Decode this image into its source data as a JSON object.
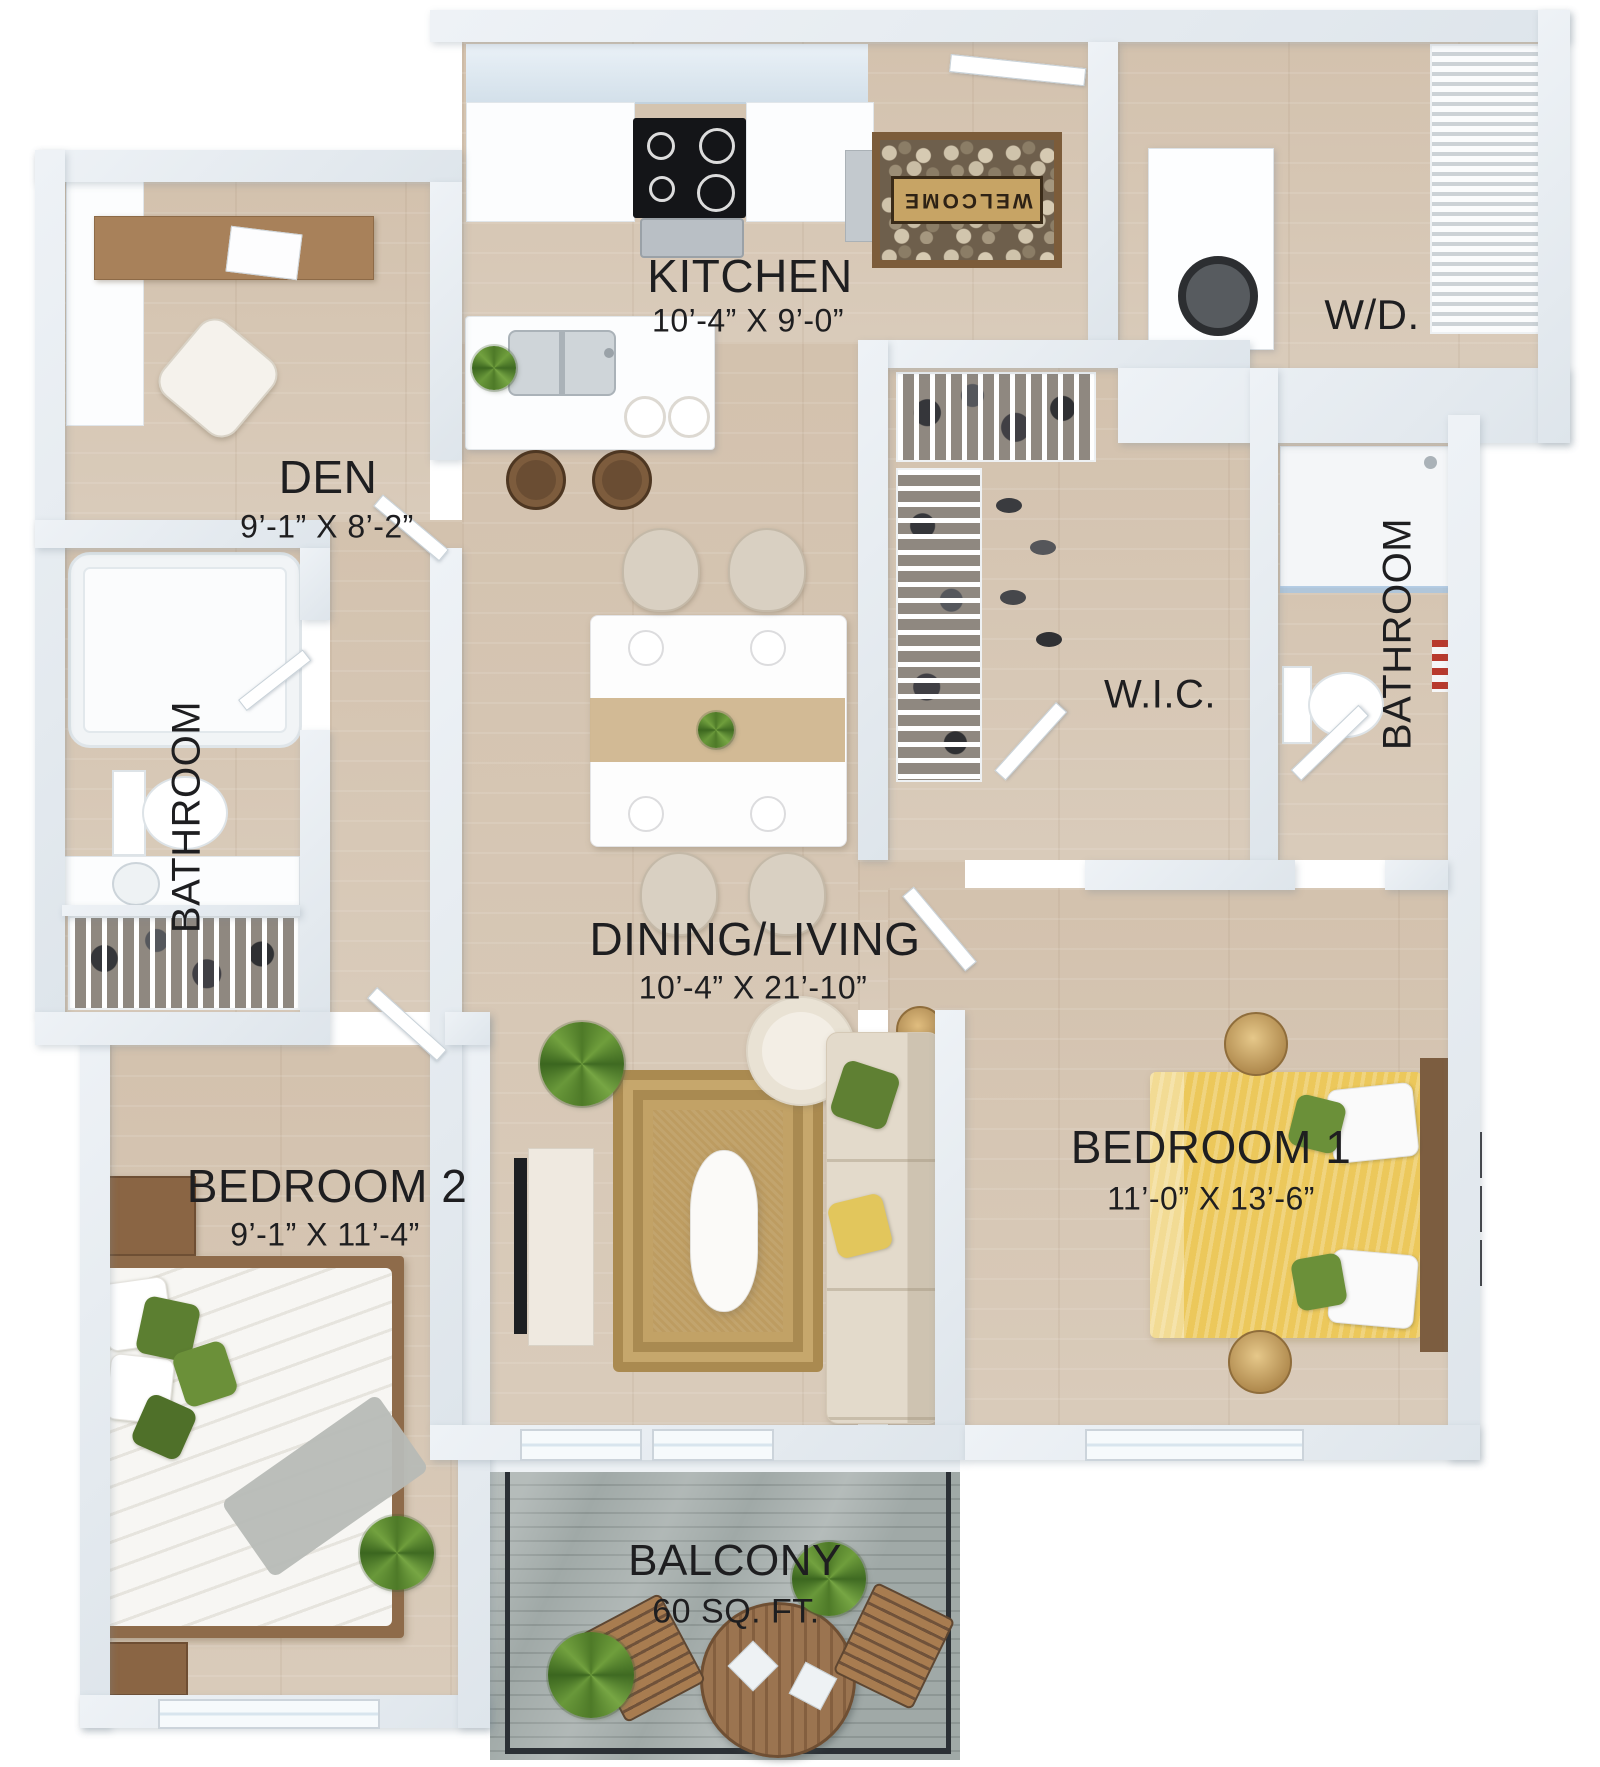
{
  "rooms": {
    "kitchen": {
      "label": "KITCHEN",
      "dims": "10’-4” X 9’-0”"
    },
    "den": {
      "label": "DEN",
      "dims": "9’-1” X 8’-2”"
    },
    "washer_dryer": {
      "label": "W/D."
    },
    "walk_in_closet": {
      "label": "W.I.C."
    },
    "bathroom_right": {
      "label": "BATHROOM"
    },
    "bathroom_left": {
      "label": "BATHROOM"
    },
    "dining_living": {
      "label": "DINING/LIVING",
      "dims": "10’-4” X 21’-10”"
    },
    "bedroom_1": {
      "label": "BEDROOM 1",
      "dims": "11’-0” X 13’-6”"
    },
    "bedroom_2": {
      "label": "BEDROOM 2",
      "dims": "9’-1” X 11’-4”"
    },
    "balcony": {
      "label": "BALCONY",
      "dims": "60 SQ. FT."
    }
  },
  "decor": {
    "welcome_mat_text": "WELCOME"
  },
  "colors": {
    "wall": "#e8edf2",
    "floor_wood": "#d7c8b6",
    "balcony_deck": "#97a19f",
    "bed_yellow": "#ecc85b",
    "pillow_green": "#5f8033",
    "rug_tan": "#bd9c61",
    "label_text": "#1e1e20"
  }
}
